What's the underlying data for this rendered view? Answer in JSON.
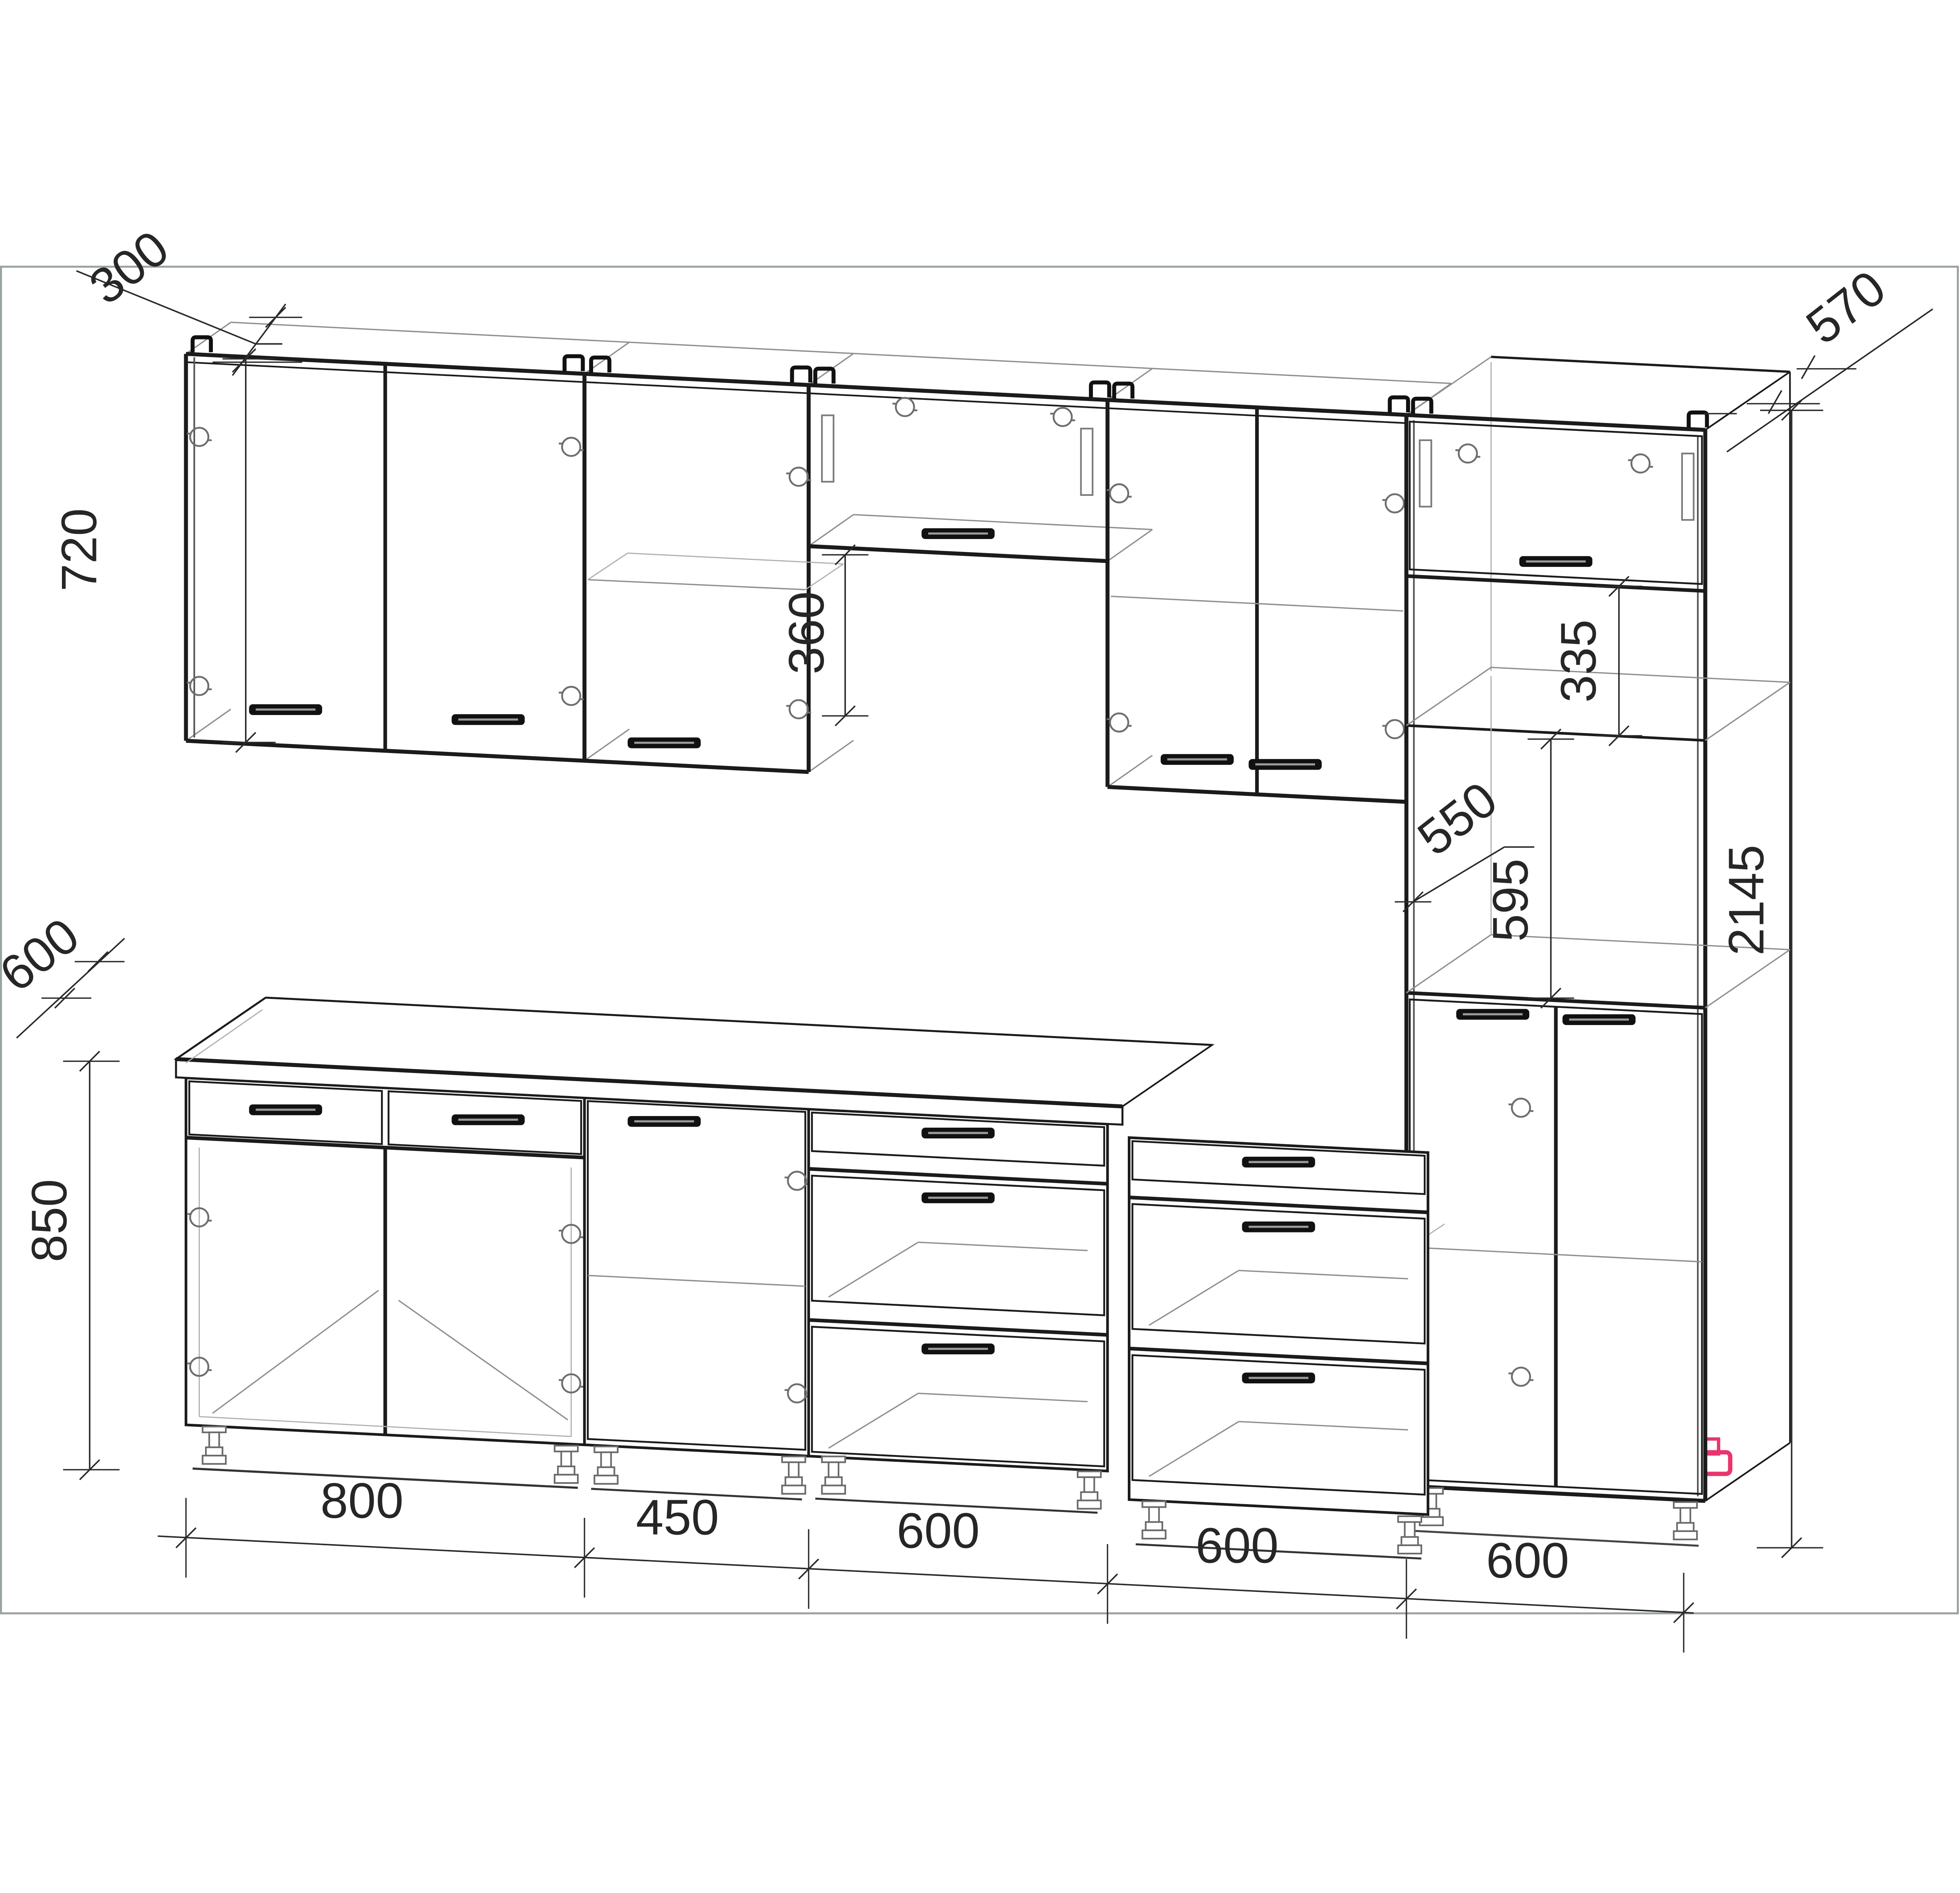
{
  "drawing": {
    "type": "kitchen-cabinet-set-technical-drawing",
    "units": "mm"
  },
  "colors": {
    "line": "#1b1b1b",
    "dimension_text": "#262626",
    "wireframe": "#8f8f8f",
    "sheet_frame": "#9aa39f",
    "highlight_leg": "#e8356d",
    "background": "#ffffff"
  },
  "dimensions": {
    "wall_cabinet_depth": "300",
    "wall_cabinet_height": "720",
    "hood_wall_cabinet_height": "360",
    "tall_cabinet_depth": "570",
    "worktop_depth": "600",
    "base_cabinet_height": "850",
    "tall_open_shelf_height": "335",
    "tall_oven_niche_depth": "550",
    "tall_oven_niche_height": "595",
    "tall_cabinet_total_height": "2145",
    "bottom_widths": [
      "800",
      "450",
      "600",
      "600",
      "600"
    ]
  }
}
